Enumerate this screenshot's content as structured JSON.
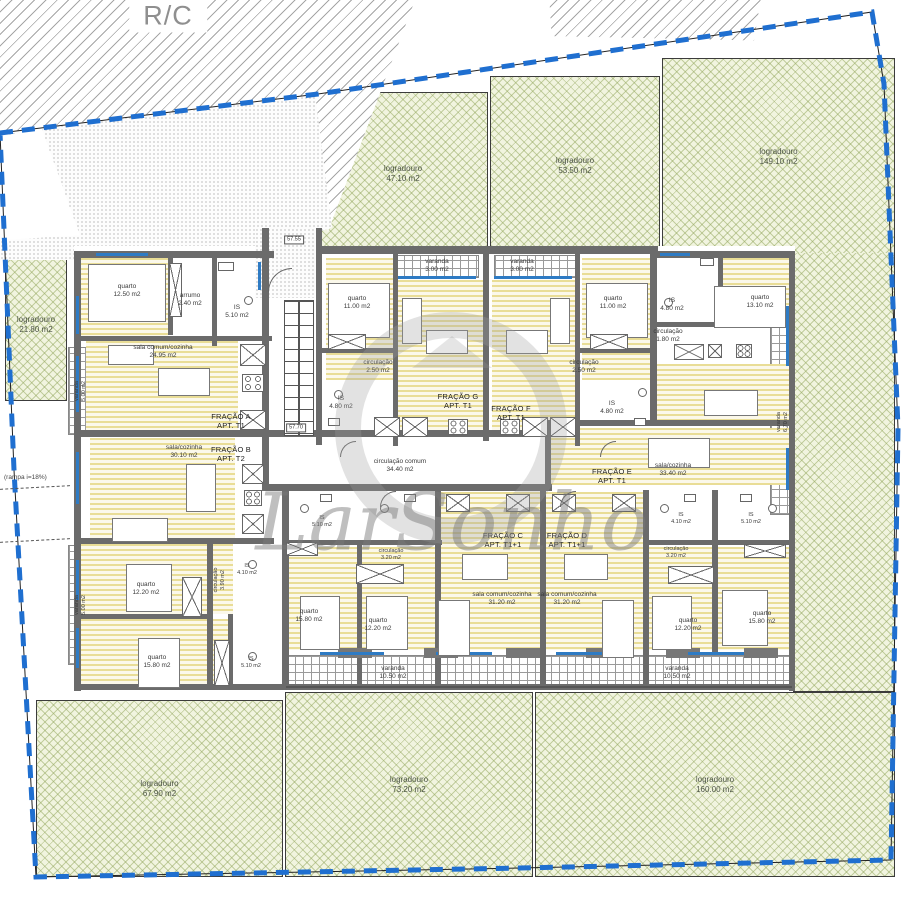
{
  "title": {
    "floor_label": "R/C"
  },
  "watermark": {
    "text": "LarSonho"
  },
  "site": {
    "ramp_note": "(rampa i=18%)",
    "level_marks": [
      "57.55",
      "57.70"
    ],
    "boundary_color": "#1f6fd0"
  },
  "logradouros": [
    {
      "label": "logradouro",
      "area": "47.10 m2"
    },
    {
      "label": "logradouro",
      "area": "53.50 m2"
    },
    {
      "label": "logradouro",
      "area": "149.10 m2"
    },
    {
      "label": "logradouro",
      "area": "21.80 m2"
    },
    {
      "label": "logradouro",
      "area": "67.90 m2"
    },
    {
      "label": "logradouro",
      "area": "73.20 m2"
    },
    {
      "label": "logradouro",
      "area": "160.00 m2"
    }
  ],
  "fracoes": [
    {
      "name": "FRAÇÃO A",
      "apt": "APT. T1"
    },
    {
      "name": "FRAÇÃO B",
      "apt": "APT. T2"
    },
    {
      "name": "FRAÇÃO G",
      "apt": "APT. T1"
    },
    {
      "name": "FRAÇÃO F",
      "apt": "APT. T1"
    },
    {
      "name": "FRAÇÃO E",
      "apt": "APT. T1"
    },
    {
      "name": "FRAÇÃO C",
      "apt": "APT. T1+1"
    },
    {
      "name": "FRAÇÃO D",
      "apt": "APT. T1+1"
    }
  ],
  "corridor": {
    "label": "circulação comum",
    "area": "34.40 m2"
  },
  "rooms": [
    {
      "label": "quarto",
      "area": "12.50 m2"
    },
    {
      "label": "arrumo",
      "area": "2.40 m2"
    },
    {
      "label": "IS",
      "area": "5.10 m2"
    },
    {
      "label": "sala comum/cozinha",
      "area": "24.95 m2"
    },
    {
      "label": "quarto",
      "area": "11.00 m2"
    },
    {
      "label": "circulação",
      "area": "2.50 m2"
    },
    {
      "label": "IS",
      "area": "4.80 m2"
    },
    {
      "label": "varanda",
      "area": "3.00 m2"
    },
    {
      "label": "quarto",
      "area": "11.00 m2"
    },
    {
      "label": "circulação",
      "area": "2.50 m2"
    },
    {
      "label": "IS",
      "area": "4.80 m2"
    },
    {
      "label": "varanda",
      "area": "3.00 m2"
    },
    {
      "label": "IS",
      "area": "4.80 m2"
    },
    {
      "label": "quarto",
      "area": "13.10 m2"
    },
    {
      "label": "circulação",
      "area": "1.80 m2"
    },
    {
      "label": "varanda",
      "area": "6.70 m2"
    },
    {
      "label": "sala/cozinha",
      "area": "30.10 m2"
    },
    {
      "label": "quarto",
      "area": "12.20 m2"
    },
    {
      "label": "quarto",
      "area": "15.80 m2"
    },
    {
      "label": "IS",
      "area": "4.10 m2"
    },
    {
      "label": "IS",
      "area": "5.10 m2"
    },
    {
      "label": "circulação",
      "area": "3.90 m2"
    },
    {
      "label": "IS",
      "area": "5.10 m2"
    },
    {
      "label": "circulação",
      "area": "3.20 m2"
    },
    {
      "label": "quarto",
      "area": "15.80 m2"
    },
    {
      "label": "quarto",
      "area": "12.20 m2"
    },
    {
      "label": "sala comum/cozinha",
      "area": "31.20 m2"
    },
    {
      "label": "sala comum/cozinha",
      "area": "31.20 m2"
    },
    {
      "label": "circulação",
      "area": "3.20 m2"
    },
    {
      "label": "quarto",
      "area": "12.20 m2"
    },
    {
      "label": "quarto",
      "area": "15.80 m2"
    },
    {
      "label": "IS",
      "area": "4.10 m2"
    },
    {
      "label": "IS",
      "area": "5.10 m2"
    },
    {
      "label": "sala/cozinha",
      "area": "33.40 m2"
    },
    {
      "label": "varanda",
      "area": "10.50 m2"
    },
    {
      "label": "varanda",
      "area": "10.50 m2"
    },
    {
      "label": "varanda",
      "area": "5.00 m2"
    },
    {
      "label": "varanda",
      "area": "5.00 m2"
    }
  ]
}
